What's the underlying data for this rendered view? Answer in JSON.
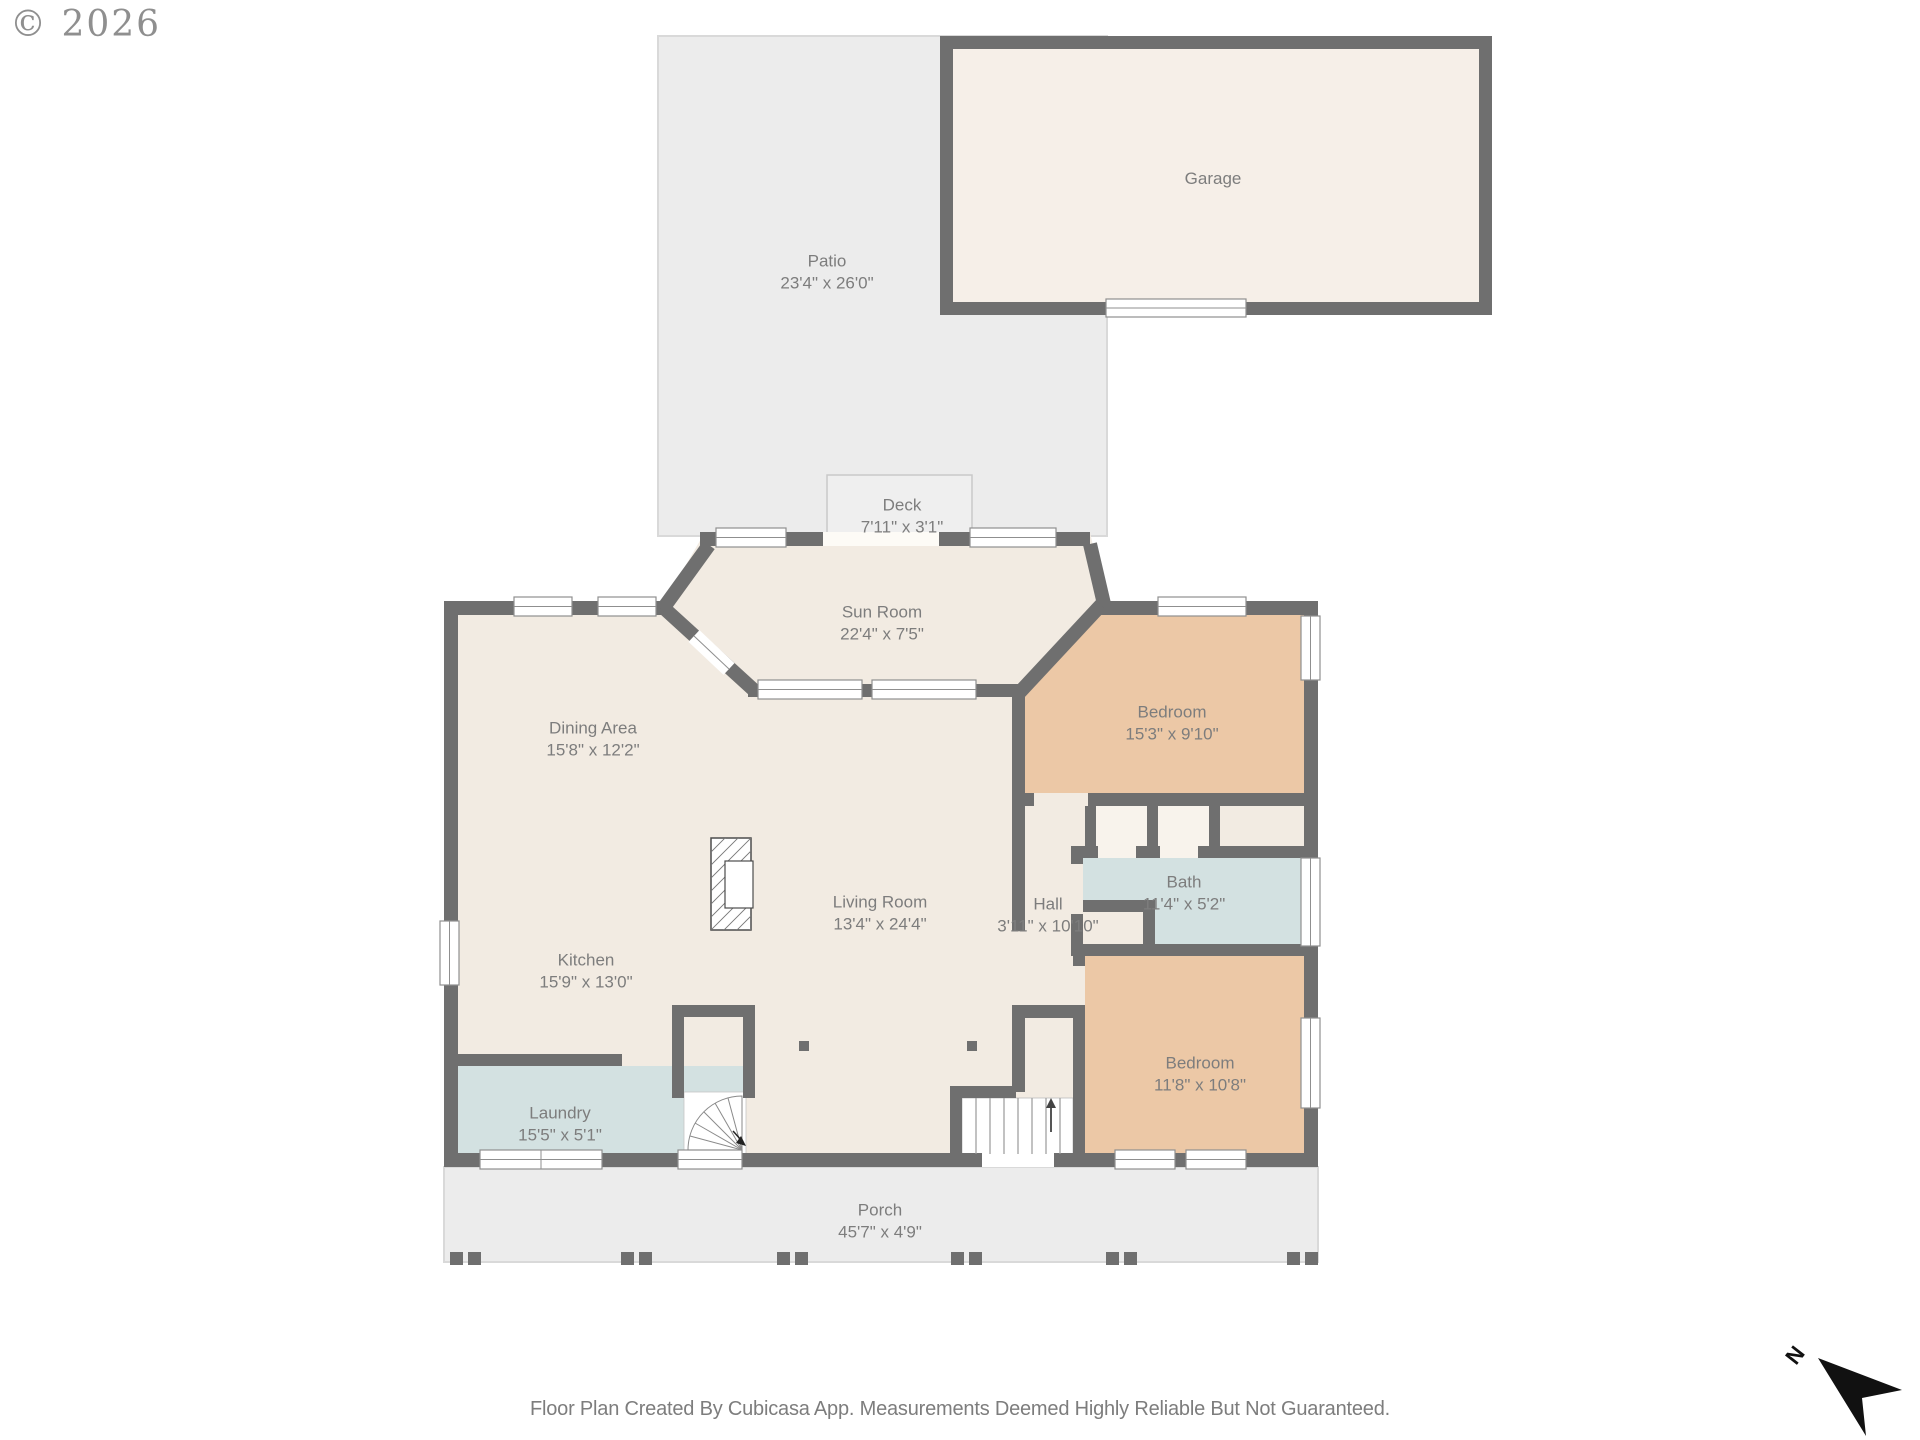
{
  "watermark": "© 2026",
  "footer": "Floor Plan Created By Cubicasa App. Measurements Deemed Highly Reliable But Not Guaranteed.",
  "compass": {
    "label": "N"
  },
  "rooms": {
    "patio": {
      "name": "Patio",
      "dims": "23'4\" x 26'0\""
    },
    "garage": {
      "name": "Garage",
      "dims": ""
    },
    "deck": {
      "name": "Deck",
      "dims": "7'11\" x 3'1\""
    },
    "sun_room": {
      "name": "Sun Room",
      "dims": "22'4\" x 7'5\""
    },
    "dining": {
      "name": "Dining Area",
      "dims": "15'8\" x 12'2\""
    },
    "bedroom1": {
      "name": "Bedroom",
      "dims": "15'3\" x 9'10\""
    },
    "bath": {
      "name": "Bath",
      "dims": "11'4\" x 5'2\""
    },
    "hall": {
      "name": "Hall",
      "dims": "3'11\" x 10'10\""
    },
    "living": {
      "name": "Living Room",
      "dims": "13'4\" x 24'4\""
    },
    "kitchen": {
      "name": "Kitchen",
      "dims": "15'9\" x 13'0\""
    },
    "bedroom2": {
      "name": "Bedroom",
      "dims": "11'8\" x 10'8\""
    },
    "laundry": {
      "name": "Laundry",
      "dims": "15'5\" x 5'1\""
    },
    "porch": {
      "name": "Porch",
      "dims": "45'7\" x 4'9\""
    }
  },
  "colors": {
    "wall": "#6f6f6f",
    "floor": "#f2ebe2",
    "garage_floor": "#f6efe8",
    "accent_tan": "#ecc8a6",
    "accent_blue": "#d3e1e1",
    "outdoor_gray": "#ececec",
    "label_text": "#7d7d7d"
  }
}
